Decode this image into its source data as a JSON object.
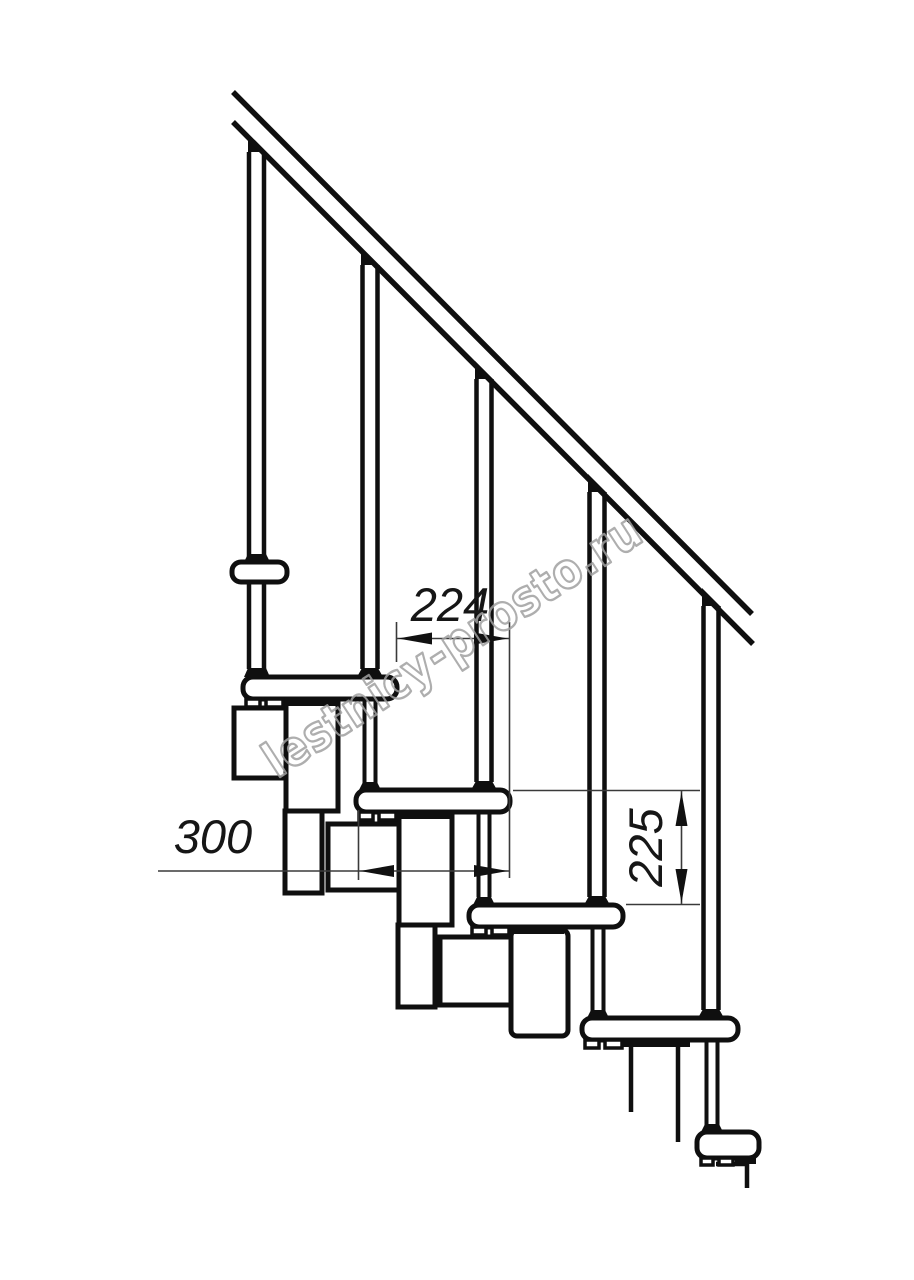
{
  "document": {
    "title": "Modular staircase side view technical drawing",
    "background": "#ffffff",
    "line_color": "#0f0f0f",
    "dimension_line_color": "#3a3a3a",
    "dimension_text_color": "#161616",
    "dimensions": {
      "step_offset_horizontal": "224",
      "tread_depth": "300",
      "step_rise": "225"
    },
    "watermark": {
      "text": "lestnicy-prosto.ru",
      "color": "#a0a0a0"
    }
  }
}
